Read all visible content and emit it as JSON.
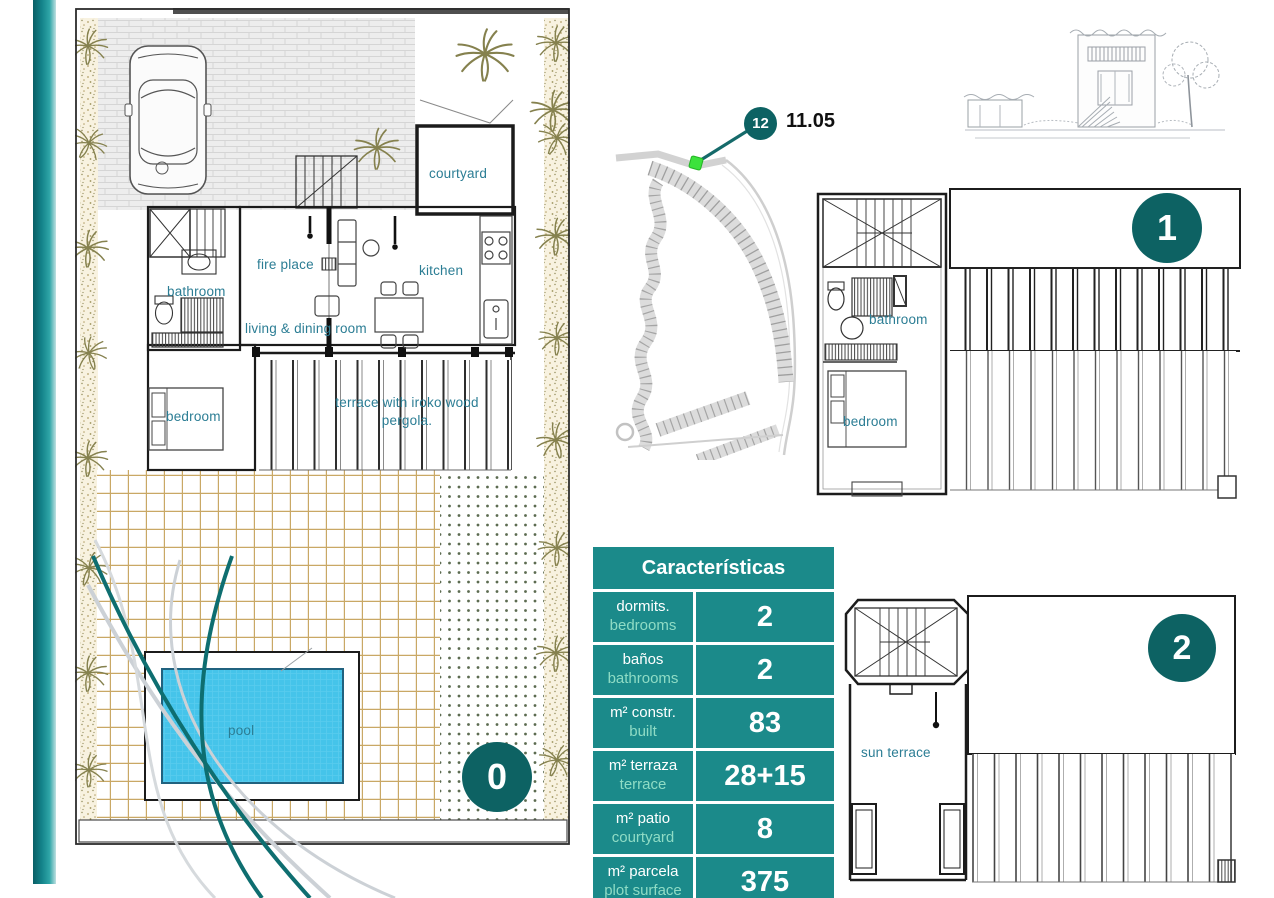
{
  "colors": {
    "table_teal": "#1b8a8a",
    "badge_teal": "#0d6263",
    "accent_light_green": "#8fdcc5",
    "room_label_teal": "#2b7d94",
    "pool_blue": "#45c4ea",
    "marker_green": "#3ce23c",
    "garden_tan": "#c9a865",
    "swoosh_teal": "#0e6e70",
    "swoosh_gray": "#ccd1d6"
  },
  "ground_floor": {
    "badge": "0",
    "labels": {
      "courtyard": "courtyard",
      "bathroom": "bathroom",
      "fire_place": "fire place",
      "kitchen": "kitchen",
      "living_dining": "living & dining room",
      "bedroom": "bedroom",
      "terrace": "terrace with iroko wood pergola.",
      "pool": "pool"
    }
  },
  "site_map": {
    "plot_badge": "12",
    "elevation": "11.05"
  },
  "floor_1": {
    "badge": "1",
    "labels": {
      "bathroom": "bathroom",
      "bedroom": "bedroom"
    }
  },
  "floor_2": {
    "badge": "2",
    "labels": {
      "sun_terrace": "sun terrace"
    }
  },
  "characteristics_table": {
    "title": "Características",
    "rows": [
      {
        "label_es": "dormits.",
        "label_en": "bedrooms",
        "value": "2"
      },
      {
        "label_es": "baños",
        "label_en": "bathrooms",
        "value": "2"
      },
      {
        "label_es": "m² constr.",
        "label_en": "built",
        "value": "83"
      },
      {
        "label_es": "m² terraza",
        "label_en": "terrace",
        "value": "28+15"
      },
      {
        "label_es": "m² patio",
        "label_en": "courtyard",
        "value": "8"
      },
      {
        "label_es": "m² parcela",
        "label_en": "plot surface",
        "value": "375"
      }
    ]
  }
}
